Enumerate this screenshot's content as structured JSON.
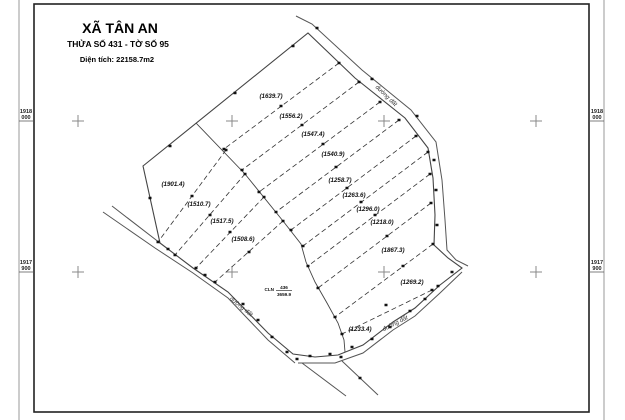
{
  "title_block": {
    "commune": "XÃ TÂN AN",
    "parcel_line": "THỬA SỐ 431 - TỜ SỐ 95",
    "area_line": "Diện tích: 22158.7m2"
  },
  "roads": {
    "label": "đường đất"
  },
  "grid_coords": {
    "top_value": "1918",
    "top_sub": "000",
    "bottom_value": "1917",
    "bottom_sub": "900"
  },
  "parcels": {
    "left": [
      "(1901.4)",
      "(1510.7)",
      "(1517.5)",
      "(1508.6)"
    ],
    "right": [
      "(1639.7)",
      "(1556.2)",
      "(1547.4)",
      "(1540.9)",
      "(1258.7)",
      "(1263.6)",
      "(1296.0)",
      "(1218.0)",
      "(1867.3)",
      "(1269.2)"
    ],
    "bottom": [
      "(1233.4)"
    ],
    "center_parcel": {
      "land_type": "CLN",
      "number": "436",
      "area": "3659.9"
    }
  },
  "colors": {
    "frame": "#222222",
    "outer_line": "#999999",
    "boundary": "#444444",
    "dashed": "#333333",
    "cross": "#888888",
    "marker": "#111111"
  }
}
